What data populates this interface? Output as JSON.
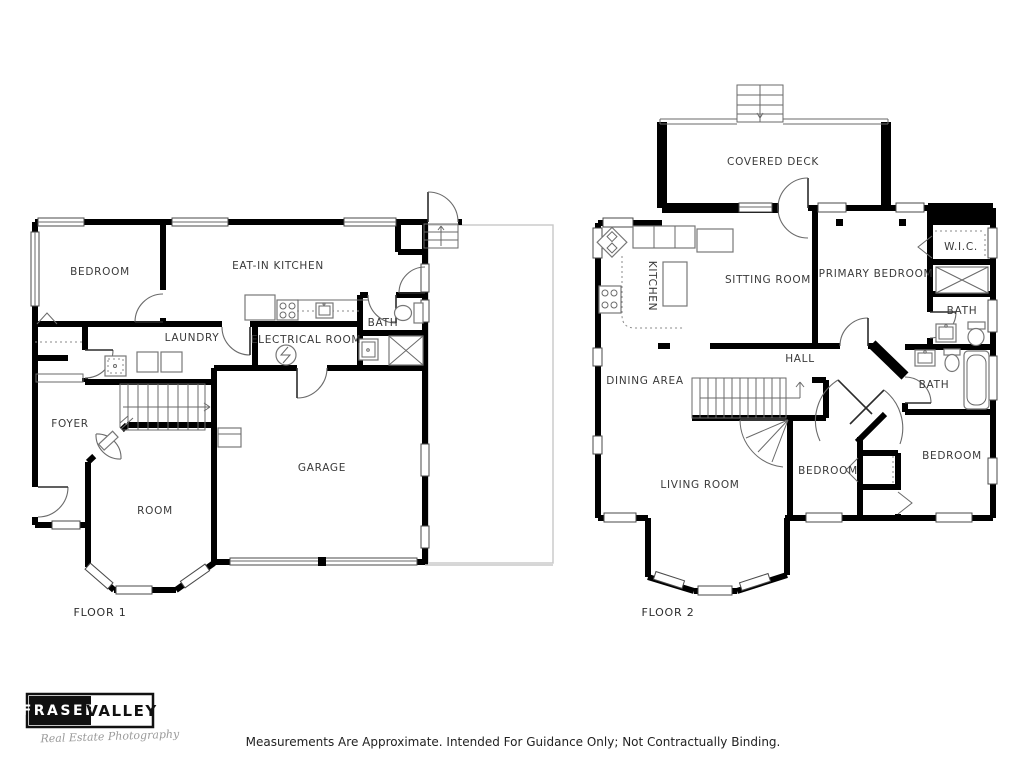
{
  "floor1": {
    "title": "FLOOR 1",
    "rooms": {
      "bedroom": "BEDROOM",
      "eat_in_kitchen": "EAT-IN KITCHEN",
      "laundry": "LAUNDRY",
      "electrical_room": "ELECTRICAL ROOM",
      "bath": "BATH",
      "foyer": "FOYER",
      "room": "ROOM",
      "garage": "GARAGE"
    }
  },
  "floor2": {
    "title": "FLOOR 2",
    "rooms": {
      "covered_deck": "COVERED DECK",
      "kitchen": "KITCHEN",
      "sitting_room": "SITTING ROOM",
      "primary_bedroom": "PRIMARY BEDROOM",
      "wic": "W.I.C.",
      "bath_upper": "BATH",
      "hall": "HALL",
      "dining_area": "DINING AREA",
      "bath_lower": "BATH",
      "living_room": "LIVING ROOM",
      "bedroom_center": "BEDROOM",
      "bedroom_right": "BEDROOM"
    }
  },
  "logo": {
    "brand_primary": "FRASER",
    "brand_secondary": "VALLEY",
    "tagline": "Real Estate Photography"
  },
  "footer": {
    "disclaimer": "Measurements Are Approximate. Intended For Guidance Only; Not Contractually Binding."
  },
  "colors": {
    "wall": "#000000",
    "window_line": "#444444",
    "fixture_line": "#777777",
    "label_text": "#3a3a3a",
    "driveway_line": "#c8c8c8"
  }
}
